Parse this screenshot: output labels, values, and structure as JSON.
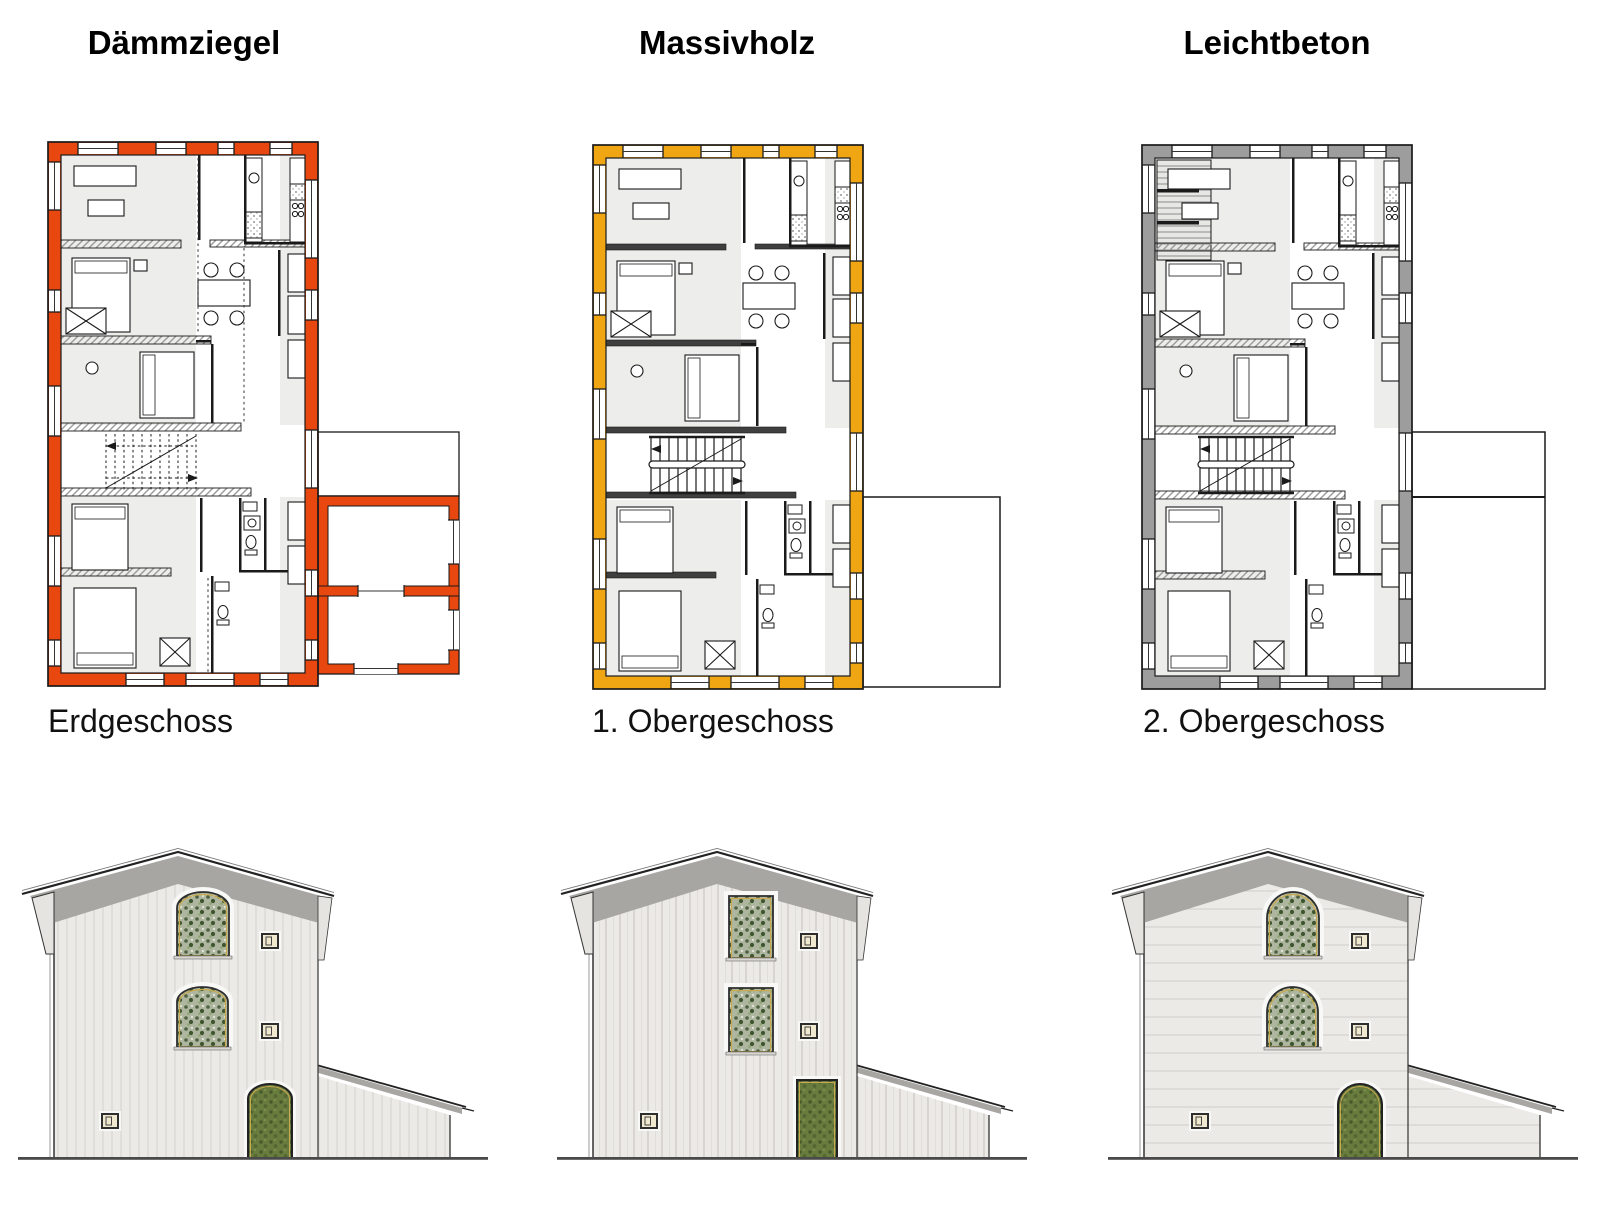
{
  "sheet_title": "Material comparison floor plans and elevations",
  "columns": [
    {
      "title": "Dämmziegel",
      "floor_label": "Erdgeschoss",
      "wall_color": "#e8470f",
      "plan": {
        "stairs": "dashed",
        "interior_walls": "hatched",
        "annex": "walled-rooms",
        "balcony": false
      },
      "elevation": {
        "windows": "arched",
        "door": "arched",
        "texture": "plaster-vertical"
      }
    },
    {
      "title": "Massivholz",
      "floor_label": "1. Obergeschoss",
      "wall_color": "#f0a513",
      "plan": {
        "stairs": "solid",
        "interior_walls": "solid",
        "annex": "open-outline",
        "balcony": false
      },
      "elevation": {
        "windows": "rectangular",
        "door": "rectangular",
        "texture": "vertical-planks"
      }
    },
    {
      "title": "Leichtbeton",
      "floor_label": "2. Obergeschoss",
      "wall_color": "#9d9d9d",
      "plan": {
        "stairs": "solid",
        "interior_walls": "hatched",
        "annex": "open-outline-tall",
        "balcony": true
      },
      "elevation": {
        "windows": "round-arched",
        "door": "round-arched",
        "texture": "horizontal-boards"
      }
    }
  ],
  "colors": {
    "line": "#1a1a1a",
    "room_fill": "#ededeb",
    "hatch_gray": "#9a9a9a",
    "solid_wall_gray": "#3f3f3f",
    "facade": "#eceae6",
    "roof_band": "#a7a6a3",
    "ground_line": "#4a4a4a",
    "foliage_base": "#aeb6a0",
    "foliage_dark": "#4e6140",
    "door_green": "#687c3e",
    "frame_accent": "#c9a94e"
  }
}
